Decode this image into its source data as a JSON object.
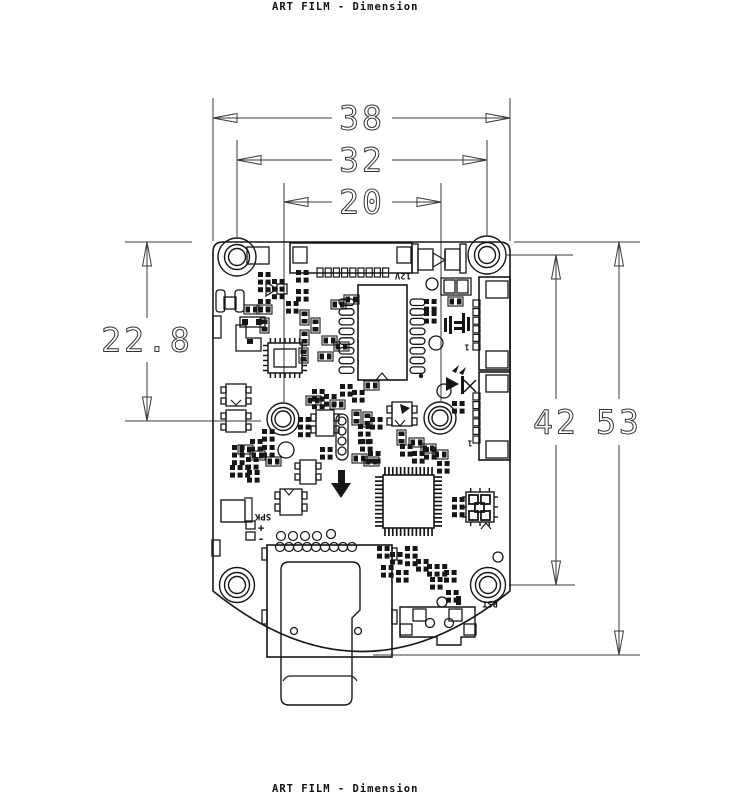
{
  "header": {
    "title": "ART FILM - Dimension"
  },
  "footer": {
    "title": "ART FILM - Dimension"
  },
  "colors": {
    "ink": "#161616",
    "dim": "#3a3a3a",
    "bg": "#ffffff"
  },
  "dimensions": [
    {
      "label": "38",
      "dir": "h",
      "line": 118,
      "from": 213,
      "to": 510,
      "text_at": 362,
      "gap": 30
    },
    {
      "label": "32",
      "dir": "h",
      "line": 160,
      "from": 237,
      "to": 487,
      "text_at": 362,
      "gap": 30
    },
    {
      "label": "20",
      "dir": "h",
      "line": 202,
      "from": 284,
      "to": 441,
      "text_at": 362,
      "gap": 30
    },
    {
      "label": "22.8",
      "dir": "v",
      "line": 147,
      "from": 242,
      "to": 421,
      "text_at": 340,
      "gap": 22
    },
    {
      "label": "42",
      "dir": "v",
      "line": 556,
      "from": 255,
      "to": 585,
      "text_at": 422,
      "gap": 23
    },
    {
      "label": "53",
      "dir": "v",
      "line": 619,
      "from": 242,
      "to": 655,
      "text_at": 422,
      "gap": 23
    }
  ],
  "ext_lines": [
    [
      213,
      98,
      213,
      241
    ],
    [
      510,
      98,
      510,
      241
    ],
    [
      237,
      140,
      237,
      237
    ],
    [
      487,
      140,
      487,
      235
    ],
    [
      284,
      183,
      284,
      402
    ],
    [
      441,
      183,
      441,
      401
    ],
    [
      125,
      242,
      192,
      242
    ],
    [
      125,
      421,
      261,
      421
    ],
    [
      507,
      255,
      573,
      255
    ],
    [
      509,
      585,
      575,
      585
    ],
    [
      514,
      242,
      640,
      242
    ],
    [
      373,
      655,
      640,
      655
    ]
  ],
  "board": {
    "outline_path": "M 213 252 Q 213 242 223 242 L 500 242 Q 510 242 510 252 L 510 591 Q 362 712 213 591 Z",
    "holes": [
      [
        237,
        257,
        [
          19,
          12.5,
          8.5
        ]
      ],
      [
        487,
        255,
        [
          19,
          12.5,
          8.5
        ]
      ],
      [
        283,
        419,
        [
          16,
          11.5,
          8
        ]
      ],
      [
        440,
        418,
        [
          16,
          11.5,
          8
        ]
      ],
      [
        237,
        585,
        [
          17.5,
          12.5,
          8.5
        ]
      ],
      [
        488,
        585,
        [
          17.5,
          12.5,
          8.5
        ]
      ]
    ],
    "rects": [
      [
        247,
        247,
        22,
        17
      ],
      [
        290,
        243,
        122,
        30,
        1.5
      ],
      [
        293,
        247,
        14,
        16
      ],
      [
        397,
        247,
        14,
        16
      ],
      [
        412,
        244,
        6,
        29
      ],
      [
        460,
        244,
        6,
        29
      ],
      [
        418,
        249,
        15,
        21
      ],
      [
        445,
        249,
        15,
        21
      ],
      [
        358,
        285,
        49,
        95,
        1.6
      ],
      [
        479,
        277,
        31,
        93,
        1.6
      ],
      [
        486,
        281,
        22,
        17
      ],
      [
        486,
        351,
        22,
        17
      ],
      [
        479,
        372,
        31,
        88,
        1.6
      ],
      [
        486,
        375,
        22,
        17
      ],
      [
        486,
        441,
        22,
        17
      ],
      [
        216,
        290,
        9,
        22,
        1.3,
        3
      ],
      [
        235,
        290,
        9,
        22,
        1.3,
        3
      ],
      [
        224,
        297,
        12,
        12
      ],
      [
        240,
        317,
        25,
        10
      ],
      [
        268,
        343,
        34,
        30,
        1.5
      ],
      [
        274,
        349,
        22,
        18
      ],
      [
        226,
        384,
        20,
        22
      ],
      [
        221,
        387,
        5,
        6
      ],
      [
        221,
        398,
        5,
        6
      ],
      [
        246,
        387,
        5,
        6
      ],
      [
        246,
        398,
        5,
        6
      ],
      [
        226,
        410,
        20,
        22
      ],
      [
        221,
        413,
        5,
        6
      ],
      [
        221,
        424,
        5,
        6
      ],
      [
        246,
        413,
        5,
        6
      ],
      [
        246,
        424,
        5,
        6
      ],
      [
        213,
        316,
        8,
        22
      ],
      [
        212,
        540,
        8,
        16
      ],
      [
        441,
        278,
        30,
        17
      ],
      [
        444,
        280,
        11,
        13
      ],
      [
        457,
        280,
        11,
        13
      ],
      [
        316,
        410,
        18,
        26
      ],
      [
        311,
        414,
        5,
        7
      ],
      [
        311,
        426,
        5,
        7
      ],
      [
        334,
        414,
        5,
        7
      ],
      [
        334,
        426,
        5,
        7
      ],
      [
        392,
        402,
        20,
        24
      ],
      [
        387,
        406,
        5,
        7
      ],
      [
        387,
        418,
        5,
        7
      ],
      [
        412,
        406,
        5,
        7
      ],
      [
        412,
        418,
        5,
        7
      ],
      [
        300,
        460,
        16,
        24
      ],
      [
        295,
        463,
        5,
        6
      ],
      [
        295,
        474,
        5,
        6
      ],
      [
        316,
        463,
        5,
        6
      ],
      [
        316,
        474,
        5,
        6
      ],
      [
        280,
        489,
        22,
        26
      ],
      [
        275,
        492,
        5,
        7
      ],
      [
        275,
        504,
        5,
        7
      ],
      [
        302,
        492,
        5,
        7
      ],
      [
        302,
        504,
        5,
        7
      ],
      [
        336,
        414,
        12,
        46,
        1.3,
        6
      ],
      [
        383,
        475,
        51,
        53,
        1.6
      ],
      [
        466,
        492,
        28,
        30,
        1.4
      ],
      [
        469,
        495,
        9,
        9,
        1.8
      ],
      [
        481,
        495,
        9,
        9,
        1.8
      ],
      [
        469,
        511,
        9,
        9,
        1.8
      ],
      [
        481,
        511,
        9,
        9,
        1.8
      ],
      [
        475,
        503,
        9,
        9,
        1.8
      ],
      [
        221,
        500,
        24,
        22,
        1.4
      ],
      [
        246,
        521,
        9,
        8
      ],
      [
        246,
        532,
        9,
        8
      ],
      [
        267,
        545,
        125,
        112,
        1.6
      ],
      [
        262,
        548,
        5,
        12
      ],
      [
        262,
        610,
        5,
        14
      ],
      [
        392,
        548,
        5,
        12
      ],
      [
        392,
        610,
        5,
        14
      ],
      [
        413,
        609,
        13,
        12
      ],
      [
        449,
        609,
        13,
        12
      ],
      [
        400,
        624,
        12,
        11
      ],
      [
        464,
        624,
        12,
        11
      ],
      [
        277,
        284,
        10,
        10
      ]
    ],
    "frects": [
      [
        444,
        318,
        3,
        14
      ],
      [
        449,
        316,
        3,
        18
      ],
      [
        454,
        321,
        8,
        3
      ],
      [
        454,
        327,
        8,
        3
      ],
      [
        462,
        313,
        3,
        20
      ],
      [
        467,
        317,
        3,
        14
      ],
      [
        461,
        376,
        3,
        18
      ],
      [
        242,
        319,
        6,
        6
      ],
      [
        256,
        319,
        6,
        6
      ],
      [
        247,
        339,
        6,
        5
      ],
      [
        456,
        596,
        5,
        9
      ]
    ],
    "circles": [
      [
        432,
        284,
        6
      ],
      [
        436,
        343,
        7
      ],
      [
        444,
        391,
        7
      ],
      [
        286,
        450,
        8
      ],
      [
        342,
        421,
        4
      ],
      [
        342,
        431,
        4
      ],
      [
        342,
        441,
        4
      ],
      [
        342,
        451,
        4
      ],
      [
        331,
        534,
        4.5
      ],
      [
        294,
        631,
        3.5
      ],
      [
        358,
        631,
        3.5
      ],
      [
        430,
        623,
        4.5
      ],
      [
        449,
        623,
        4.5
      ],
      [
        442,
        602,
        5
      ],
      [
        498,
        557,
        5
      ]
    ],
    "fcircles": [
      [
        421,
        376,
        2.2
      ]
    ],
    "circle_rows": [
      [
        281,
        536,
        4,
        12,
        4.5
      ],
      [
        280,
        547,
        9,
        9,
        4.5
      ]
    ],
    "oval_cols": [
      [
        339,
        299,
        8,
        9.7,
        15,
        6.5
      ],
      [
        410,
        299,
        8,
        9.7,
        15,
        6.5
      ]
    ],
    "pad_rows": [
      [
        317,
        268,
        9,
        8.2,
        0,
        6,
        9
      ],
      [
        473,
        300,
        6,
        0,
        8.6,
        7,
        7
      ],
      [
        473,
        393,
        6,
        0,
        8.6,
        7,
        7
      ]
    ],
    "pad_grids": [
      [
        258,
        272,
        2,
        3
      ],
      [
        272,
        279,
        2,
        3
      ],
      [
        296,
        270,
        2,
        2
      ],
      [
        296,
        289,
        2,
        2
      ],
      [
        286,
        301,
        2,
        2
      ],
      [
        258,
        299,
        2,
        2
      ],
      [
        424,
        299,
        2,
        2
      ],
      [
        424,
        311,
        2,
        2
      ],
      [
        437,
        461,
        2,
        2
      ],
      [
        377,
        546,
        2,
        2
      ],
      [
        390,
        552,
        2,
        2
      ],
      [
        405,
        546,
        2,
        3
      ],
      [
        416,
        559,
        2,
        2
      ],
      [
        381,
        565,
        2,
        2
      ],
      [
        396,
        570,
        2,
        2
      ],
      [
        427,
        564,
        3,
        2
      ],
      [
        452,
        401,
        2,
        2
      ],
      [
        452,
        497,
        2,
        3
      ],
      [
        340,
        384,
        2,
        2
      ],
      [
        352,
        390,
        2,
        2
      ],
      [
        298,
        417,
        2,
        3
      ],
      [
        250,
        439,
        2,
        2
      ],
      [
        262,
        445,
        2,
        2
      ],
      [
        232,
        445,
        2,
        3
      ],
      [
        246,
        457,
        2,
        2
      ],
      [
        230,
        465,
        3,
        2
      ],
      [
        262,
        429,
        2,
        2
      ],
      [
        320,
        447,
        2,
        2
      ],
      [
        360,
        439,
        2,
        2
      ],
      [
        368,
        451,
        2,
        2
      ],
      [
        400,
        444,
        2,
        2
      ],
      [
        412,
        451,
        2,
        2
      ],
      [
        424,
        447,
        2,
        2
      ],
      [
        358,
        424,
        2,
        3
      ],
      [
        370,
        417,
        2,
        2
      ],
      [
        312,
        389,
        2,
        3
      ],
      [
        324,
        394,
        2,
        2
      ],
      [
        247,
        470,
        2,
        2
      ],
      [
        430,
        577,
        2,
        2
      ],
      [
        444,
        570,
        2,
        2
      ],
      [
        446,
        590,
        2,
        2
      ]
    ],
    "r2": [
      [
        244,
        305
      ],
      [
        257,
        305
      ],
      [
        300,
        330,
        1
      ],
      [
        299,
        348,
        1
      ],
      [
        318,
        352
      ],
      [
        331,
        300
      ],
      [
        344,
        295
      ],
      [
        306,
        396
      ],
      [
        330,
        400
      ],
      [
        364,
        381
      ],
      [
        352,
        410,
        1
      ],
      [
        363,
        412,
        1
      ],
      [
        397,
        430,
        1
      ],
      [
        409,
        438
      ],
      [
        421,
        444
      ],
      [
        433,
        450
      ],
      [
        352,
        454
      ],
      [
        364,
        457
      ],
      [
        300,
        310,
        1
      ],
      [
        311,
        318,
        1
      ],
      [
        322,
        336
      ],
      [
        334,
        342
      ],
      [
        260,
        318,
        1
      ],
      [
        448,
        297
      ],
      [
        238,
        445
      ],
      [
        250,
        451
      ],
      [
        266,
        457
      ]
    ],
    "ic_pins": [
      [
        383,
        475,
        51,
        53,
        13,
        13,
        8,
        1.7
      ],
      [
        268,
        343,
        34,
        30,
        7,
        6,
        5,
        1.5
      ],
      [
        466,
        492,
        28,
        30,
        3,
        3,
        4,
        1.4
      ]
    ],
    "paths": [
      [
        "M236 325 h10 v13 h15 v13 h-25 z",
        1.3
      ],
      [
        "M244 498 h8 v24 h-8",
        1.2
      ],
      [
        "M281 570 q0 -8 8 -8 h63 q8 0 8 8 v40 l-8 8 v79 q0 8 -8 8 h-55 q-8 0 -8 -8 z",
        1.4
      ],
      [
        "M283 681 q3 -5 7 -5 h60 q4 0 7 5",
        1.2
      ],
      [
        "M400 607 h75 v30 h-14 v8 h-24 v-8 h-37 z",
        1.4
      ],
      [
        "M376 380 l6 -7 l6 7",
        1.2
      ],
      [
        "M266 282 v14 l11 -7 z",
        1.2
      ],
      [
        "M433 253 v14 l12 -7 z",
        1.2
      ],
      [
        "M445 251 v17",
        1.4
      ],
      [
        "M395 420 l5 6 l5 -6",
        1.1
      ],
      [
        "M284 489 l5 6 l5 -6",
        1.1
      ],
      [
        "M481 529 l5 -6 l5 6",
        1.1
      ],
      [
        "M231 400 l5 5 l5 -5",
        1.1
      ],
      [
        "M464 380 l12 12 M476 380 l-12 12",
        1.5
      ]
    ],
    "fpaths": [
      "M338 470 h7 v13 h6 l-10 15 l-10 -15 h7 z",
      "M400 404 l10 4 l-8 6 z",
      "M446 377 l13 7 l-13 7 z",
      "M452 371 l7 -6 l-3 8 z",
      "M459 373 l7 -6 l-3 8 z"
    ],
    "texts": [
      [
        403,
        275,
        "12V",
        9,
        180
      ],
      [
        263,
        516,
        "SPK",
        9,
        180
      ],
      [
        490,
        603,
        "RST",
        8.5,
        180
      ],
      [
        467,
        347,
        "1",
        8,
        180
      ],
      [
        470,
        443,
        "1",
        8,
        180
      ],
      [
        261,
        528,
        "+",
        11,
        0
      ],
      [
        261,
        539,
        "-",
        11,
        0
      ]
    ]
  }
}
